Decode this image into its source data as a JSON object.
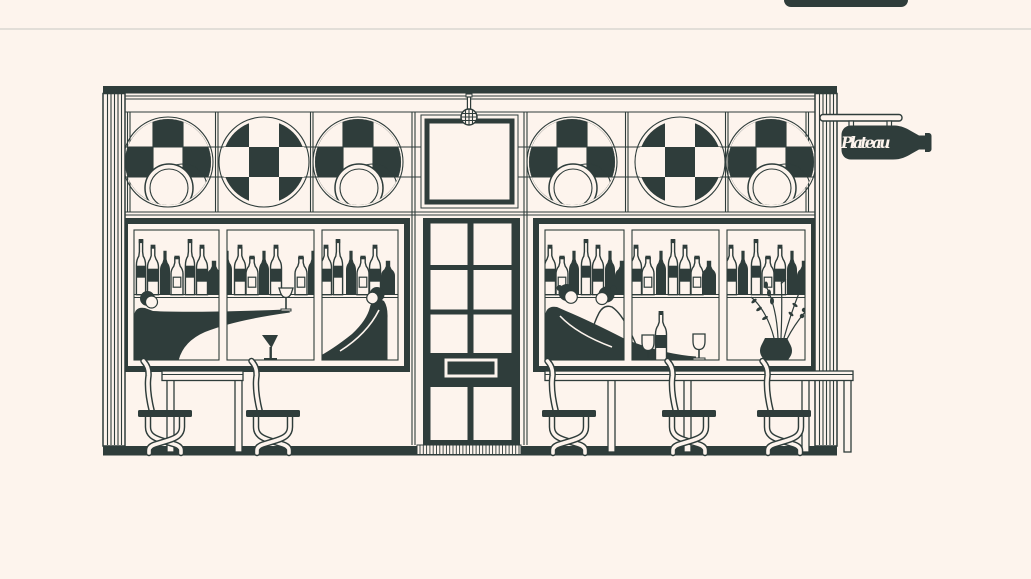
{
  "colors": {
    "ink": "#2F3D3B",
    "paper": "#FDF4ED",
    "divider": "#E2DED8"
  },
  "top_button": {
    "label": ""
  },
  "illustration": {
    "title": "wine-bar storefront line illustration",
    "sign": {
      "text": "Plateau",
      "shape": "wine-bottle"
    },
    "medallion_count": 6,
    "window_count": 2,
    "stool_count": 5,
    "scene": [
      "checkerboard circle medallions with plates",
      "shelves of wine bottles",
      "seated patrons with wine glasses",
      "paneled door with letterbox and doormat",
      "hanging wine-bottle sign",
      "bar stools and counters",
      "vase with flowers"
    ]
  }
}
